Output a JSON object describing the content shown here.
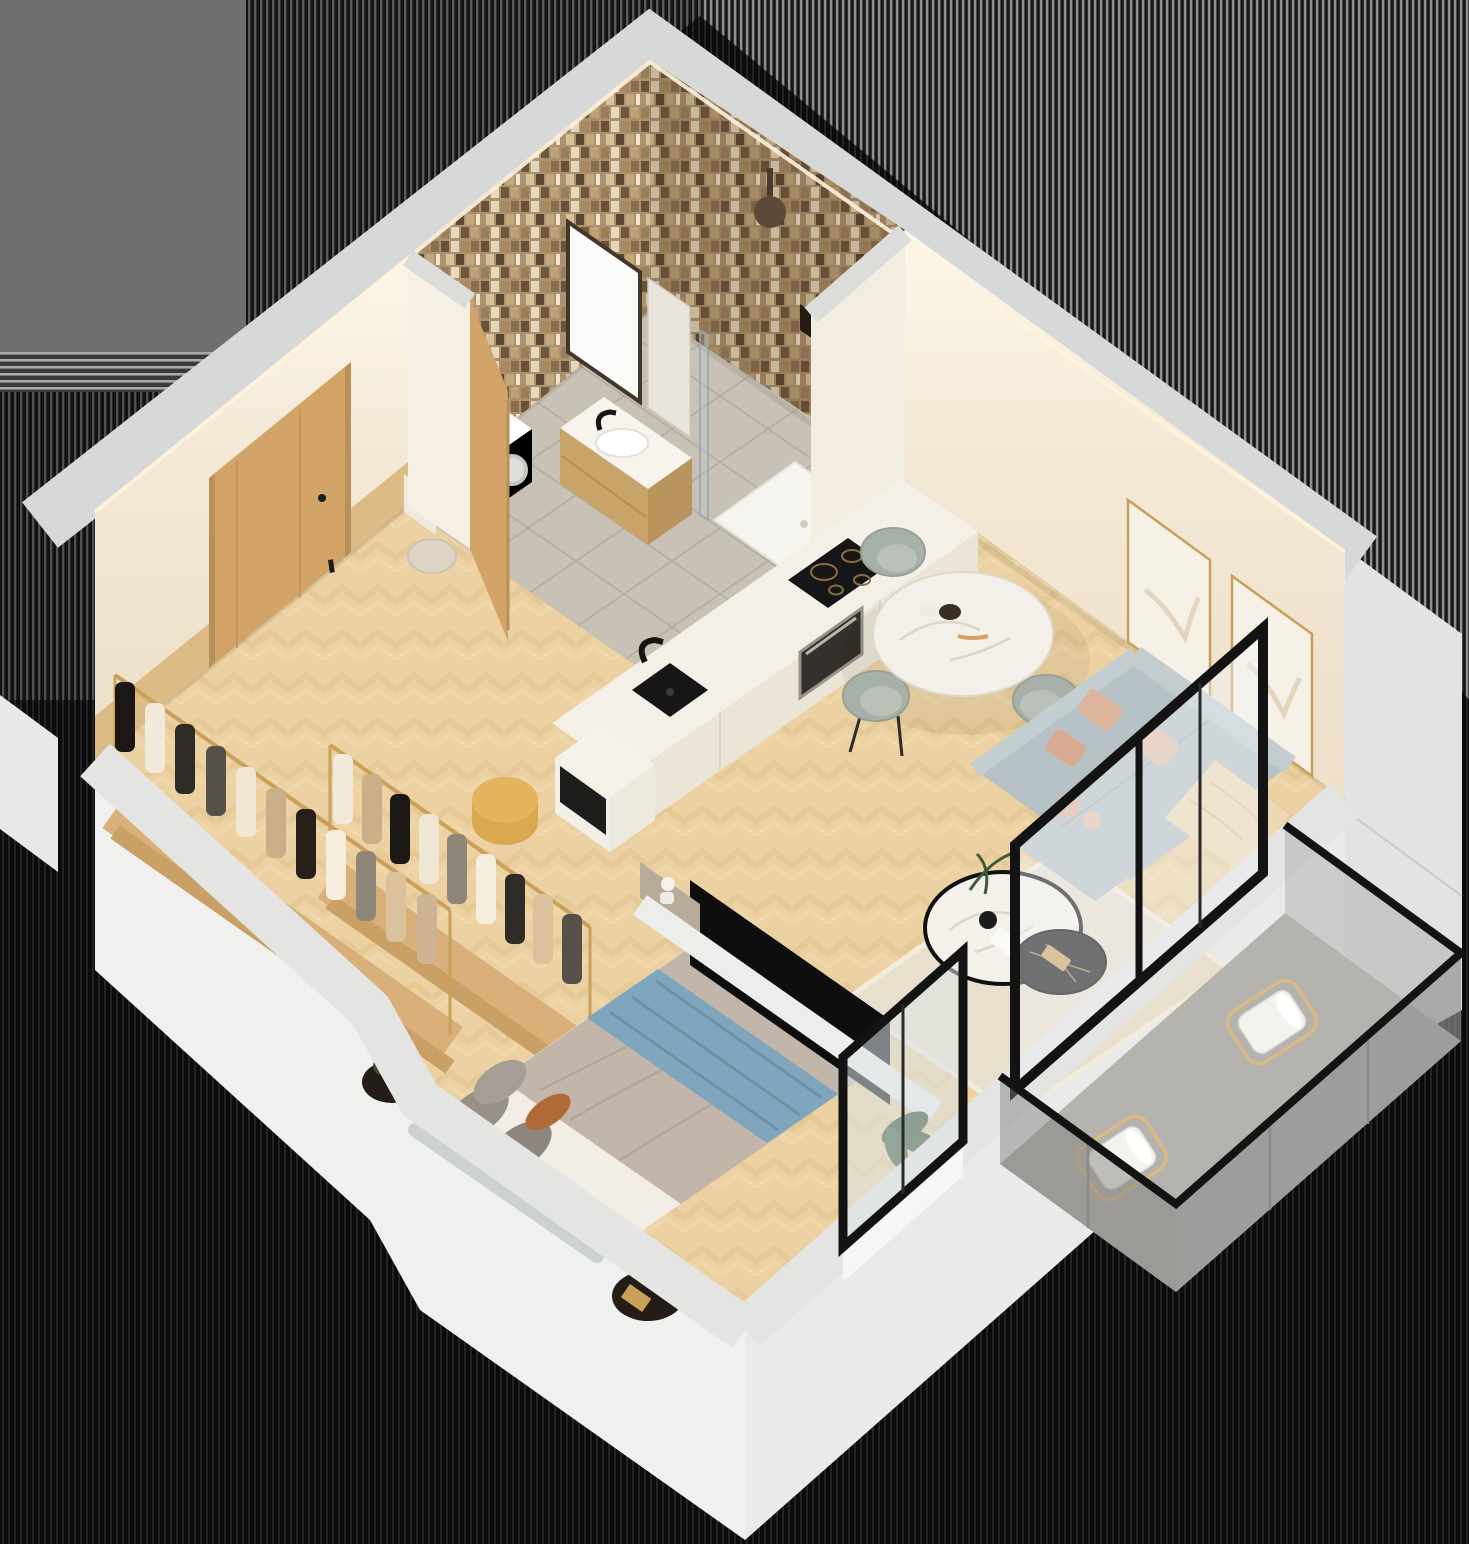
{
  "scene": {
    "type": "isometric-apartment-floor-plan",
    "rooms": [
      {
        "id": "bathroom",
        "items": [
          "mosaic-tile-walls",
          "wall-mirror",
          "wood-vanity-with-sink",
          "washing-machine",
          "toilet",
          "walk-in-shower",
          "shower-head",
          "glass-shower-screen"
        ]
      },
      {
        "id": "entry-hall",
        "items": [
          "entry-door",
          "wood-wainscot",
          "storage-cabinet",
          "tan-pouf",
          "open-bathroom-door"
        ]
      },
      {
        "id": "kitchen",
        "items": [
          "white-counter-run",
          "black-undermount-sink",
          "black-faucet",
          "induction-cooktop",
          "built-in-oven",
          "island-cabinet"
        ]
      },
      {
        "id": "dining-area",
        "items": [
          "round-marble-table",
          "dark-wood-table-base",
          "velvet-dining-chairs",
          "table-decor"
        ]
      },
      {
        "id": "living-room",
        "items": [
          "gray-blue-sofa",
          "blush-velvet-pillows",
          "cream-throw-blanket",
          "two-gold-frame-artworks",
          "cream-rug",
          "marble-coffee-table",
          "black-nesting-table",
          "wall-mounted-tv",
          "tv-partition-wall",
          "potted-plant",
          "glass-sliding-door"
        ]
      },
      {
        "id": "wardrobe",
        "items": [
          "clothing-rack-row-1",
          "clothing-rack-row-2",
          "hanging-garments",
          "wood-platforms"
        ]
      },
      {
        "id": "bedroom",
        "items": [
          "double-bed",
          "taupe-duvet",
          "blue-throw-blanket",
          "gray-pillows",
          "rust-accent-pillow",
          "curved-headboard",
          "black-nightstand-left",
          "black-nightstand-right",
          "bedroom-window"
        ]
      },
      {
        "id": "balcony",
        "items": [
          "glass-railing",
          "black-top-rail",
          "lounge-chair-near",
          "lounge-chair-far",
          "stone-floor"
        ]
      }
    ],
    "colors": {
      "background": "#0a0a0a",
      "backdrop_gray": "#6f6f6f",
      "wall_top": "#d7d8d8",
      "wall_outer": "#f0f0ef",
      "wall_outer_shade": "#e2e3e2",
      "wall_cream": "#f4ead8",
      "wall_cream_deep": "#efe3cf",
      "floor_wood": "#ecd2a2",
      "floor_tile": "#c8c2b6",
      "counter_top": "#f4f0e7",
      "counter_front": "#ebe5d7",
      "appliance_black": "#161616",
      "oven": "#34302b",
      "door_wood": "#d2a468",
      "wood_panel": "#ddbb84",
      "chair_sage": "#a8b1a9",
      "table_marble": "#f3f0ea",
      "table_base": "#55402e",
      "sofa": "#b6c2c6",
      "pillow_blush": "#ddb49c",
      "throw_cream": "#ecd9b3",
      "rug": "#e8dfcd",
      "coffee_marble": "#f4f1ea",
      "side_table_black": "#141414",
      "gold": "#c9a05a",
      "tv_black": "#0e0e0e",
      "partition": "#ededeb",
      "bed_duvet": "#c2b6aa",
      "bed_blue": "#7fa6bd",
      "bed_sheet": "#f2eee6",
      "pillow_gray": "#98918a",
      "pillow_rust": "#b06a38",
      "headboard": "#ccd1d2",
      "nightstand": "#241c16",
      "plant_green": "#34502f",
      "balcony_floor": "#b5b3ae",
      "balcony_glass": "rgba(125,125,125,0.45)",
      "rail_black": "#131313",
      "chair_white": "#f4f2ed",
      "chair_gold": "#d9ba84",
      "washer_white": "#f7f7f5",
      "toilet_beige": "#ded4c6",
      "pouf_tan": "#d9a84f",
      "shower_tray": "#f6f4ef",
      "led_glow": "#fff3dc",
      "vanity_wood": "#c8a36a"
    }
  }
}
